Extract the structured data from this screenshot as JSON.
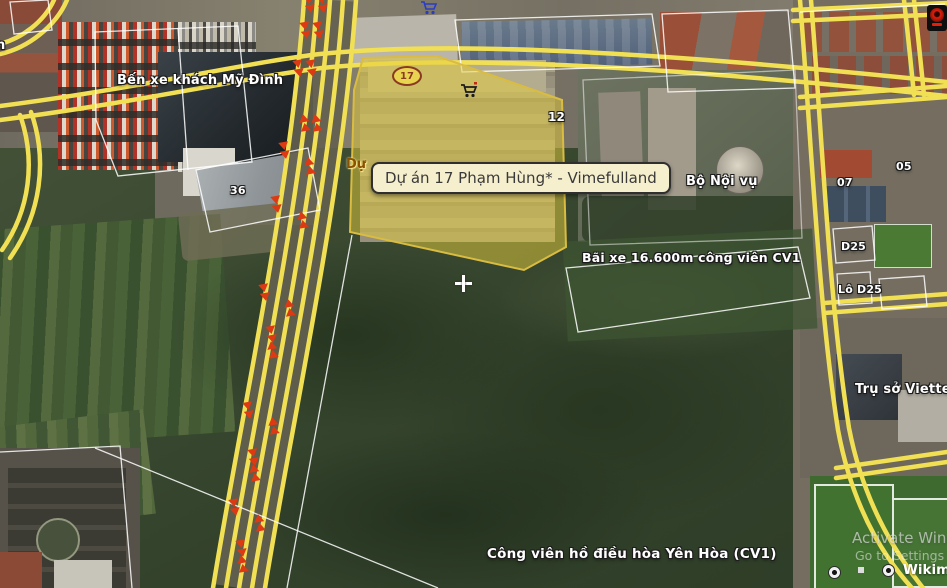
{
  "page": {
    "type": "satellite-map-view"
  },
  "tooltip": {
    "text": "Dự án 17 Phạm Hùng* - Vimefulland"
  },
  "labels": {
    "bus_station": "Bến xe khách Mỹ Đình",
    "ministry_interior": "Bộ Nội vụ",
    "parking_cv1": "Bãi xe 16.600m công viên CV1",
    "viettel_hq": "Trụ sở Viettel",
    "yen_hoa_park": "Công viên hồ điều hòa Yên Hòa (CV1)",
    "clipped_left_edge": "n",
    "project_clipped": "Dự"
  },
  "lot_markers": {
    "m36": "36",
    "m12": "12",
    "m05": "05",
    "m07": "07",
    "d25": "D25",
    "lo_d25": "Lô D25",
    "badge_17": "17"
  },
  "system_overlay": {
    "activate_line1": "Activate Windows",
    "activate_line2": "Go to Settings to activate Windows"
  },
  "attribution": {
    "logo": "Wikimapia"
  },
  "icons": {
    "cart_top": "shopping-cart-icon",
    "cart_project": "shopping-cart-icon",
    "webcam": "webcam-icon",
    "soccer_balls": "soccer-ball-icon",
    "crosshair": "map-center-crosshair",
    "traffic_arrows": "traffic-direction-arrow"
  },
  "colors": {
    "road_yellow": "#f2e054",
    "highlight_fill": "#e6ce3c",
    "highlight_border": "#d9bc41",
    "parcel_line": "#ffffff",
    "arrow_red": "#dd3912",
    "tooltip_bg": "#f6efce",
    "tooltip_border": "#2f2f2f",
    "label_text": "#ffffff"
  }
}
